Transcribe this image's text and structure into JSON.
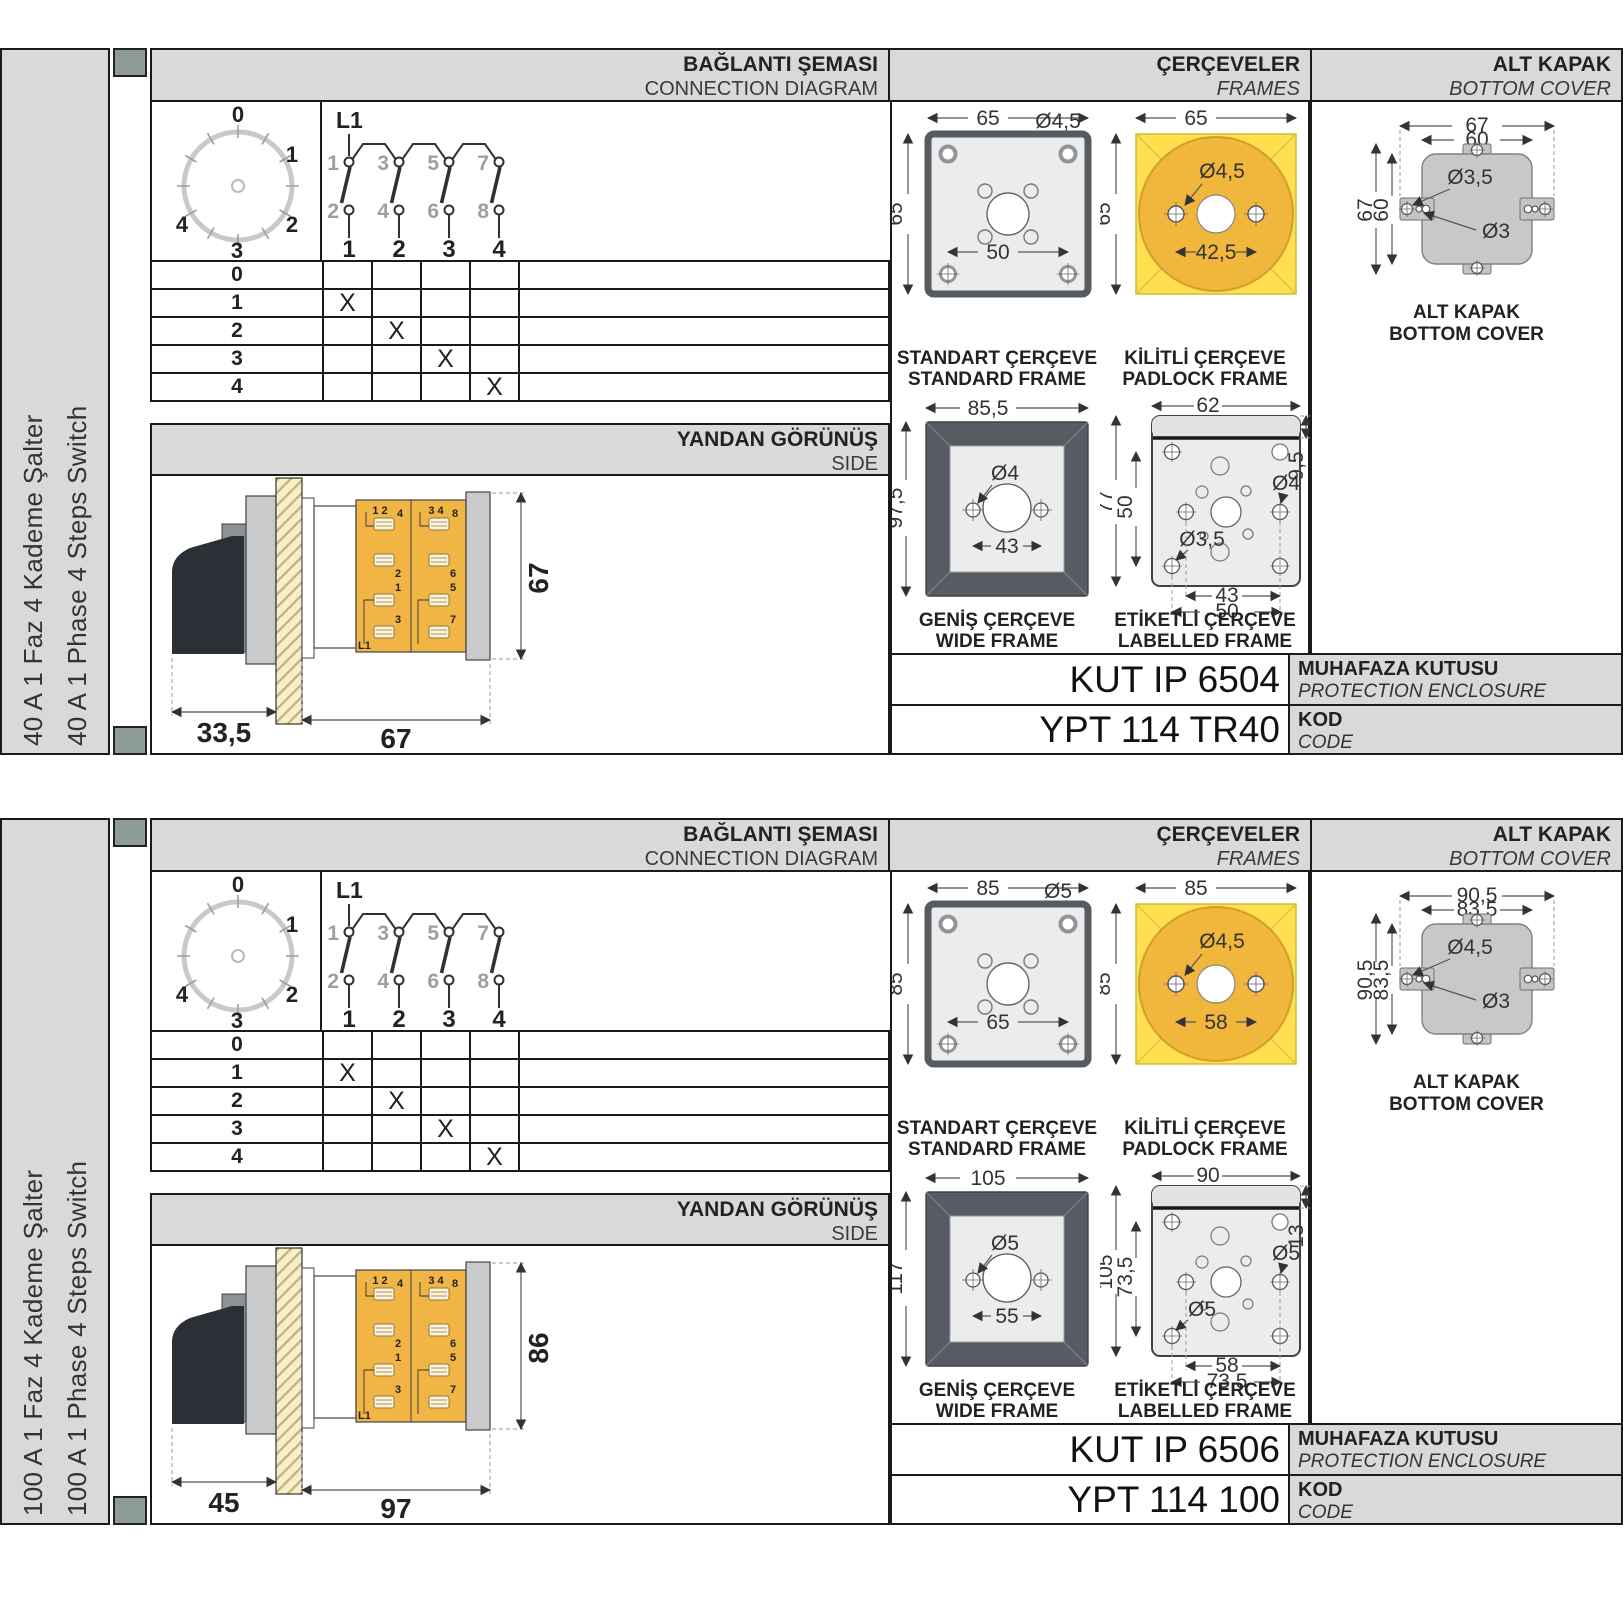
{
  "sections": [
    {
      "label_tr": "40 A 1 Faz 4 Kademe Şalter",
      "label_en": "40 A 1 Phase 4 Steps Switch",
      "headers": {
        "conn_tr": "BAĞLANTI ŞEMASI",
        "conn_en": "CONNECTION DIAGRAM",
        "frames_tr": "ÇERÇEVELER",
        "frames_en": "FRAMES",
        "cover_tr": "ALT KAPAK",
        "cover_en": "BOTTOM COVER"
      },
      "dial": {
        "p0": "0",
        "p1": "1",
        "p2": "2",
        "p3": "3",
        "p4": "4"
      },
      "schematic": {
        "l1": "L1",
        "t1": "1",
        "t2": "3",
        "t3": "5",
        "t4": "7",
        "b1": "2",
        "b2": "4",
        "b3": "6",
        "b4": "8",
        "o1": "1",
        "o2": "2",
        "o3": "3",
        "o4": "4"
      },
      "table": {
        "rows": [
          {
            "s": "0",
            "m1": "",
            "m2": "",
            "m3": "",
            "m4": ""
          },
          {
            "s": "1",
            "m1": "X",
            "m2": "",
            "m3": "",
            "m4": ""
          },
          {
            "s": "2",
            "m1": "",
            "m2": "X",
            "m3": "",
            "m4": ""
          },
          {
            "s": "3",
            "m1": "",
            "m2": "",
            "m3": "X",
            "m4": ""
          },
          {
            "s": "4",
            "m1": "",
            "m2": "",
            "m3": "",
            "m4": "X"
          }
        ]
      },
      "side": {
        "tr": "YANDAN GÖRÜNÜŞ",
        "en": "SIDE",
        "dim_handle": "33,5",
        "dim_body": "67",
        "dim_height": "67",
        "blkL_corner": "1 2",
        "blkL_t1": "4",
        "blkL_t2": "2",
        "blkL_t3": "1",
        "blkL_t4": "3",
        "blkL_bottom": "L1",
        "blkR_corner": "3 4",
        "blkR_t1": "8",
        "blkR_t2": "6",
        "blkR_t3": "5",
        "blkR_t4": "7"
      },
      "frames": {
        "std": {
          "tr": "STANDART ÇERÇEVE",
          "en": "STANDARD FRAME",
          "w": "65",
          "h": "65",
          "hole": "Ø4,5",
          "sp": "50"
        },
        "pad": {
          "tr": "KİLİTLİ ÇERÇEVE",
          "en": "PADLOCK FRAME",
          "w": "65",
          "h": "65",
          "hole": "Ø4,5",
          "sp": "42,5"
        },
        "wide": {
          "tr": "GENİŞ ÇERÇEVE",
          "en": "WIDE FRAME",
          "w": "85,5",
          "h": "97,5",
          "hole": "Ø4",
          "sp": "43"
        },
        "lab": {
          "tr": "ETİKETLİ ÇERÇEVE",
          "en": "LABELLED FRAME",
          "w": "62",
          "h": "77",
          "h_in": "50",
          "band": "9,5",
          "hole1": "Ø4",
          "hole2": "Ø3,5",
          "sp1": "43",
          "sp2": "50"
        }
      },
      "cover": {
        "tr": "ALT KAPAK",
        "en": "BOTTOM COVER",
        "w1": "67",
        "w2": "60",
        "h1": "67",
        "h2": "60",
        "hole1": "Ø3,5",
        "hole2": "Ø3"
      },
      "codes": {
        "enc": "KUT IP 6504",
        "enc_tr": "MUHAFAZA KUTUSU",
        "enc_en": "PROTECTION ENCLOSURE",
        "kod": "YPT 114 TR40",
        "kod_tr": "KOD",
        "kod_en": "CODE"
      }
    },
    {
      "label_tr": "100 A 1 Faz 4 Kademe Şalter",
      "label_en": "100 A 1 Phase 4 Steps Switch",
      "headers": {
        "conn_tr": "BAĞLANTI ŞEMASI",
        "conn_en": "CONNECTION DIAGRAM",
        "frames_tr": "ÇERÇEVELER",
        "frames_en": "FRAMES",
        "cover_tr": "ALT KAPAK",
        "cover_en": "BOTTOM COVER"
      },
      "dial": {
        "p0": "0",
        "p1": "1",
        "p2": "2",
        "p3": "3",
        "p4": "4"
      },
      "schematic": {
        "l1": "L1",
        "t1": "1",
        "t2": "3",
        "t3": "5",
        "t4": "7",
        "b1": "2",
        "b2": "4",
        "b3": "6",
        "b4": "8",
        "o1": "1",
        "o2": "2",
        "o3": "3",
        "o4": "4"
      },
      "table": {
        "rows": [
          {
            "s": "0",
            "m1": "",
            "m2": "",
            "m3": "",
            "m4": ""
          },
          {
            "s": "1",
            "m1": "X",
            "m2": "",
            "m3": "",
            "m4": ""
          },
          {
            "s": "2",
            "m1": "",
            "m2": "X",
            "m3": "",
            "m4": ""
          },
          {
            "s": "3",
            "m1": "",
            "m2": "",
            "m3": "X",
            "m4": ""
          },
          {
            "s": "4",
            "m1": "",
            "m2": "",
            "m3": "",
            "m4": "X"
          }
        ]
      },
      "side": {
        "tr": "YANDAN GÖRÜNÜŞ",
        "en": "SIDE",
        "dim_handle": "45",
        "dim_body": "97",
        "dim_height": "86",
        "blkL_corner": "1 2",
        "blkL_t1": "4",
        "blkL_t2": "2",
        "blkL_t3": "1",
        "blkL_t4": "3",
        "blkL_bottom": "L1",
        "blkR_corner": "3 4",
        "blkR_t1": "8",
        "blkR_t2": "6",
        "blkR_t3": "5",
        "blkR_t4": "7"
      },
      "frames": {
        "std": {
          "tr": "STANDART ÇERÇEVE",
          "en": "STANDARD FRAME",
          "w": "85",
          "h": "85",
          "hole": "Ø5",
          "sp": "65"
        },
        "pad": {
          "tr": "KİLİTLİ ÇERÇEVE",
          "en": "PADLOCK FRAME",
          "w": "85",
          "h": "85",
          "hole": "Ø4,5",
          "sp": "58"
        },
        "wide": {
          "tr": "GENİŞ ÇERÇEVE",
          "en": "WIDE FRAME",
          "w": "105",
          "h": "117",
          "hole": "Ø5",
          "sp": "55"
        },
        "lab": {
          "tr": "ETİKETLİ ÇERÇEVE",
          "en": "LABELLED FRAME",
          "w": "90",
          "h": "105",
          "h_in": "73,5",
          "band": "13",
          "hole1": "Ø5",
          "hole2": "Ø5",
          "sp1": "58",
          "sp2": "73,5"
        }
      },
      "cover": {
        "tr": "ALT KAPAK",
        "en": "BOTTOM COVER",
        "w1": "90,5",
        "w2": "83,5",
        "h1": "90,5",
        "h2": "83,5",
        "hole1": "Ø4,5",
        "hole2": "Ø3"
      },
      "codes": {
        "enc": "KUT IP 6506",
        "enc_tr": "MUHAFAZA KUTUSU",
        "enc_en": "PROTECTION ENCLOSURE",
        "kod": "YPT 114 100",
        "kod_tr": "KOD",
        "kod_en": "CODE"
      }
    }
  ]
}
